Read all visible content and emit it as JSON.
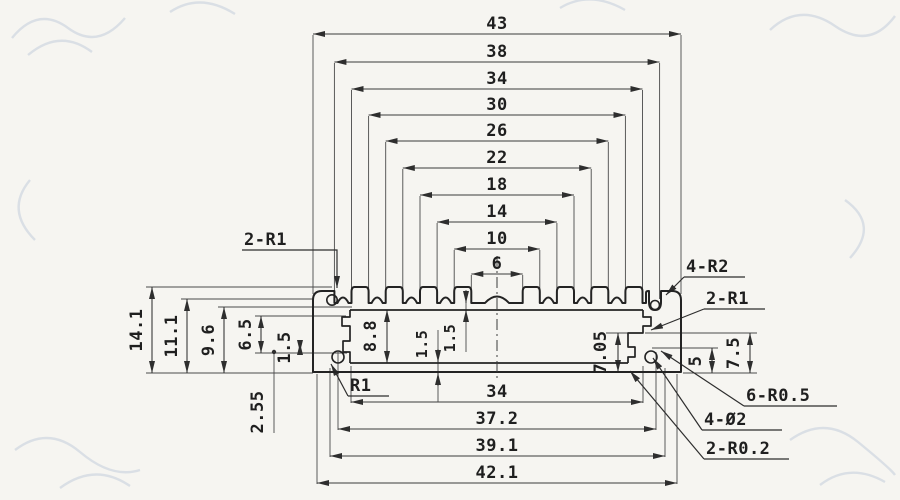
{
  "drawing": {
    "top_dims": [
      "43",
      "38",
      "34",
      "30",
      "26",
      "22",
      "18",
      "14",
      "10",
      "6"
    ],
    "bottom_dims": [
      "34",
      "37.2",
      "39.1",
      "42.1"
    ],
    "left_dims": [
      "14.1",
      "11.1",
      "9.6",
      "6.5",
      "1.5",
      "2.55"
    ],
    "inner_dims": [
      "8.8",
      "1.5",
      "1.5",
      "7.05"
    ],
    "right_dims": [
      "5",
      "7.5"
    ],
    "callouts": [
      "2-R1",
      "4-R2",
      "2-R1",
      "R1",
      "6-R0.5",
      "4-Ø2",
      "2-R0.2"
    ]
  },
  "colors": {
    "paper": "#f6f5f1",
    "ink": "#232323",
    "watermark": "#b9c6d6"
  }
}
